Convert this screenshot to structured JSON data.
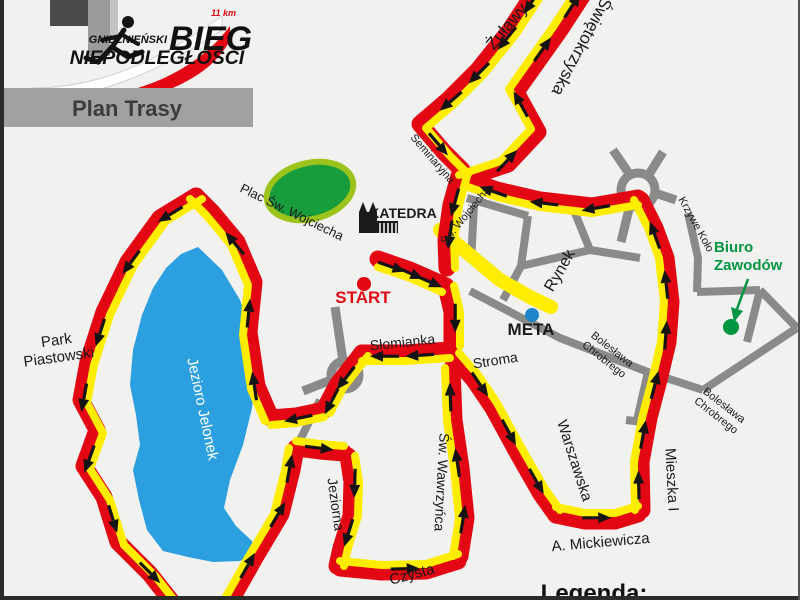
{
  "logo": {
    "distance": "11 km",
    "city": "GNIEŹNIEŃSKI",
    "bieg": "BIEG",
    "niepodleglosci": "NIEPODLEGŁOŚCI"
  },
  "banner": {
    "label": "Plan Trasy"
  },
  "legend": {
    "label": "Legenda:"
  },
  "colors": {
    "route_red": "#e30613",
    "route_yellow": "#ffed00",
    "road_gray": "#8a8a89",
    "lake_blue": "#2c9fe0",
    "park_fill": "#189d3c",
    "park_ring": "#9bc31c",
    "green": "#009540",
    "meta_blue": "#1e86c9",
    "arrow": "#141414",
    "label": "#1a1a1a"
  },
  "map": {
    "lake": [
      [
        198,
        247
      ],
      [
        222,
        270
      ],
      [
        240,
        300
      ],
      [
        252,
        335
      ],
      [
        256,
        372
      ],
      [
        252,
        408
      ],
      [
        243,
        445
      ],
      [
        230,
        480
      ],
      [
        224,
        508
      ],
      [
        236,
        526
      ],
      [
        252,
        541
      ],
      [
        256,
        553
      ],
      [
        240,
        561
      ],
      [
        213,
        562
      ],
      [
        188,
        557
      ],
      [
        163,
        551
      ],
      [
        147,
        530
      ],
      [
        139,
        500
      ],
      [
        133,
        470
      ],
      [
        140,
        445
      ],
      [
        136,
        415
      ],
      [
        130,
        385
      ],
      [
        133,
        350
      ],
      [
        142,
        315
      ],
      [
        153,
        288
      ],
      [
        166,
        268
      ],
      [
        181,
        254
      ]
    ],
    "park_ellipse": {
      "cx": 310,
      "cy": 191,
      "rx": 44,
      "ry": 28,
      "rot": -14
    },
    "roads": [
      [
        [
          467,
          198
        ],
        [
          528,
          216
        ]
      ],
      [
        [
          528,
          216
        ],
        [
          521,
          266
        ]
      ],
      [
        [
          575,
          213
        ],
        [
          590,
          250
        ]
      ],
      [
        [
          521,
          266
        ],
        [
          590,
          250
        ]
      ],
      [
        [
          590,
          250
        ],
        [
          640,
          258
        ]
      ],
      [
        [
          521,
          266
        ],
        [
          503,
          300
        ]
      ],
      [
        [
          470,
          291
        ],
        [
          560,
          338
        ],
        [
          648,
          372
        ],
        [
          703,
          390
        ]
      ],
      [
        [
          648,
          372
        ],
        [
          637,
          420
        ]
      ],
      [
        [
          626,
          420
        ],
        [
          650,
          423
        ]
      ],
      [
        [
          697,
          292
        ],
        [
          760,
          290
        ]
      ],
      [
        [
          760,
          290
        ],
        [
          797,
          328
        ]
      ],
      [
        [
          760,
          290
        ],
        [
          747,
          342
        ]
      ],
      [
        [
          703,
          390
        ],
        [
          797,
          328
        ]
      ],
      [
        [
          688,
          213
        ],
        [
          698,
          258
        ],
        [
          697,
          292
        ]
      ],
      [
        [
          474,
          205
        ],
        [
          471,
          262
        ]
      ],
      [
        [
          320,
          400
        ],
        [
          296,
          448
        ]
      ]
    ],
    "roundabouts": [
      {
        "cx": 638,
        "cy": 190,
        "r": 17,
        "arms": [
          [
            [
              630,
              175
            ],
            [
              613,
              150
            ]
          ],
          [
            [
              648,
              176
            ],
            [
              663,
              152
            ]
          ],
          [
            [
              630,
              205
            ],
            [
              621,
              242
            ]
          ],
          [
            [
              655,
              193
            ],
            [
              676,
              200
            ]
          ]
        ]
      },
      {
        "cx": 345,
        "cy": 375,
        "r": 14,
        "arms": [
          [
            [
              343,
              361
            ],
            [
              335,
              307
            ]
          ],
          [
            [
              331,
              380
            ],
            [
              303,
              391
            ]
          ]
        ]
      }
    ],
    "finish_chute": {
      "points": [
        [
          440,
          230
        ],
        [
          470,
          255
        ],
        [
          500,
          280
        ],
        [
          530,
          297
        ],
        [
          551,
          307
        ]
      ],
      "width": 14
    },
    "route": [
      {
        "id": "zulawy",
        "points": [
          [
            540,
            -16
          ],
          [
            510,
            30
          ],
          [
            478,
            70
          ],
          [
            448,
            100
          ],
          [
            420,
            124
          ],
          [
            444,
            152
          ],
          [
            462,
            170
          ]
        ],
        "off": [
          6,
          4
        ],
        "arrows": [
          0.08,
          0.26,
          0.44,
          0.6,
          0.85
        ]
      },
      {
        "id": "swietokrzyska",
        "points": [
          [
            466,
            178
          ],
          [
            508,
            164
          ],
          [
            538,
            132
          ],
          [
            516,
            92
          ],
          [
            560,
            30
          ],
          [
            590,
            -16
          ]
        ],
        "off": [
          -7,
          -3
        ],
        "arrows": [
          0.18,
          0.45,
          0.7,
          0.9
        ]
      },
      {
        "id": "sw-wojciecha",
        "points": [
          [
            459,
            176
          ],
          [
            451,
            205
          ],
          [
            446,
            240
          ],
          [
            447,
            268
          ]
        ],
        "off": [
          8,
          0
        ],
        "arrows": [
          0.3,
          0.65
        ]
      },
      {
        "id": "start-stretch",
        "points": [
          [
            378,
            259
          ],
          [
            410,
            270
          ],
          [
            442,
            284
          ]
        ],
        "off": [
          0,
          8
        ],
        "arrows": [
          0.22,
          0.5,
          0.8
        ]
      },
      {
        "id": "stroma-down",
        "points": [
          [
            446,
            286
          ],
          [
            452,
            312
          ],
          [
            452,
            346
          ]
        ],
        "off": [
          8,
          0
        ],
        "arrows": [
          0.55
        ]
      },
      {
        "id": "slomianka",
        "points": [
          [
            450,
            350
          ],
          [
            405,
            353
          ],
          [
            362,
            353
          ]
        ],
        "off": [
          0,
          8
        ],
        "arrows": [
          0.35,
          0.75
        ]
      },
      {
        "id": "to-lake",
        "points": [
          [
            362,
            353
          ],
          [
            337,
            385
          ],
          [
            324,
            410
          ]
        ],
        "off": [
          6,
          3
        ],
        "arrows": [
          0.45,
          0.85
        ]
      },
      {
        "id": "lake-out",
        "points": [
          [
            324,
            410
          ],
          [
            296,
            416
          ],
          [
            271,
            418
          ]
        ],
        "off": [
          0,
          7
        ],
        "arrows": [
          0.5
        ]
      },
      {
        "id": "lake-east-up",
        "points": [
          [
            271,
            418
          ],
          [
            257,
            386
          ],
          [
            249,
            332
          ],
          [
            254,
            282
          ],
          [
            237,
            242
          ],
          [
            212,
            212
          ],
          [
            196,
            196
          ]
        ],
        "off": [
          -6,
          3
        ],
        "arrows": [
          0.15,
          0.45,
          0.75
        ]
      },
      {
        "id": "lake-west-down",
        "points": [
          [
            196,
            196
          ],
          [
            160,
            218
          ],
          [
            128,
            262
          ],
          [
            104,
            312
          ],
          [
            88,
            362
          ],
          [
            81,
            400
          ],
          [
            97,
            430
          ],
          [
            84,
            466
          ],
          [
            104,
            497
          ],
          [
            118,
            542
          ],
          [
            150,
            574
          ],
          [
            172,
            602
          ]
        ],
        "off": [
          6,
          3
        ],
        "arrows": [
          0.07,
          0.2,
          0.36,
          0.5,
          0.64,
          0.78,
          0.92
        ]
      },
      {
        "id": "lake-return-up",
        "points": [
          [
            230,
            602
          ],
          [
            256,
            556
          ],
          [
            281,
            514
          ],
          [
            292,
            470
          ],
          [
            296,
            448
          ]
        ],
        "off": [
          -7,
          0
        ],
        "arrows": [
          0.25,
          0.6,
          0.88
        ]
      },
      {
        "id": "jeziorna-east",
        "points": [
          [
            296,
            448
          ],
          [
            320,
            451
          ],
          [
            344,
            453
          ]
        ],
        "off": [
          0,
          -7
        ],
        "arrows": [
          0.5
        ]
      },
      {
        "id": "jeziorna-down",
        "points": [
          [
            348,
            456
          ],
          [
            352,
            482
          ],
          [
            351,
            516
          ],
          [
            341,
            548
          ],
          [
            337,
            566
          ]
        ],
        "off": [
          7,
          0
        ],
        "arrows": [
          0.25,
          0.7
        ]
      },
      {
        "id": "czysta",
        "points": [
          [
            340,
            568
          ],
          [
            382,
            572
          ],
          [
            426,
            571
          ],
          [
            458,
            561
          ]
        ],
        "off": [
          0,
          -7
        ],
        "arrows": [
          0.55
        ]
      },
      {
        "id": "wawrzynca-up",
        "points": [
          [
            460,
            556
          ],
          [
            466,
            518
          ],
          [
            461,
            468
          ],
          [
            454,
            420
          ],
          [
            452,
            368
          ]
        ],
        "off": [
          -7,
          0
        ],
        "arrows": [
          0.2,
          0.5,
          0.85
        ]
      },
      {
        "id": "stroma-warszawska",
        "points": [
          [
            455,
            358
          ],
          [
            474,
            380
          ],
          [
            493,
            408
          ],
          [
            517,
            452
          ],
          [
            541,
            494
          ],
          [
            556,
            515
          ]
        ],
        "off": [
          4,
          -5
        ],
        "arrows": [
          0.2,
          0.5,
          0.8
        ]
      },
      {
        "id": "mickiewicza",
        "points": [
          [
            556,
            515
          ],
          [
            585,
            521
          ],
          [
            615,
            521
          ],
          [
            638,
            514
          ]
        ],
        "off": [
          0,
          -8
        ],
        "arrows": [
          0.5
        ]
      },
      {
        "id": "mieszka-boleslawa-up",
        "points": [
          [
            642,
            510
          ],
          [
            641,
            462
          ],
          [
            649,
            418
          ],
          [
            659,
            380
          ],
          [
            668,
            342
          ],
          [
            671,
            302
          ],
          [
            666,
            258
          ],
          [
            655,
            228
          ],
          [
            641,
            200
          ]
        ],
        "off": [
          -7,
          0
        ],
        "arrows": [
          0.08,
          0.24,
          0.4,
          0.56,
          0.72,
          0.88
        ]
      },
      {
        "id": "band-west",
        "points": [
          [
            638,
            198
          ],
          [
            592,
            206
          ],
          [
            540,
            200
          ],
          [
            497,
            190
          ],
          [
            468,
            180
          ]
        ],
        "off": [
          0,
          7
        ],
        "arrows": [
          0.25,
          0.55,
          0.85
        ]
      }
    ],
    "markers": {
      "start": {
        "x": 364,
        "y": 284,
        "r": 7
      },
      "meta": {
        "x": 532,
        "y": 315,
        "r": 7
      },
      "biuro": {
        "x": 731,
        "y": 327,
        "r": 8,
        "arrow_from": [
          748,
          279
        ],
        "arrow_to": [
          737,
          309
        ]
      }
    },
    "labels": [
      {
        "id": "zulawy",
        "text": "Żuławy",
        "x": 511,
        "y": 30,
        "rot": -50,
        "size": 17
      },
      {
        "id": "swietokrzyska",
        "text": "Świętokrzyska",
        "x": 577,
        "y": 44,
        "rot": 118,
        "size": 17
      },
      {
        "id": "seminaryjna",
        "text": "Seminaryjna",
        "x": 430,
        "y": 161,
        "rot": 49,
        "size": 11
      },
      {
        "id": "sw-wojciecha",
        "text": "Św. Wojciecha",
        "x": 468,
        "y": 218,
        "rot": -51,
        "size": 11
      },
      {
        "id": "rynek",
        "text": "Rynek",
        "x": 564,
        "y": 273,
        "rot": -60,
        "size": 16
      },
      {
        "id": "krzywe-kolo",
        "text": "Krzywe Koło",
        "x": 693,
        "y": 226,
        "rot": 61,
        "size": 11
      },
      {
        "id": "slomianka",
        "text": "Słomianka",
        "x": 403,
        "y": 347,
        "rot": -6,
        "size": 14
      },
      {
        "id": "stroma",
        "text": "Stroma",
        "x": 496,
        "y": 365,
        "rot": -9,
        "size": 14
      },
      {
        "id": "boleslawa-1",
        "lines": [
          "Bolesława",
          "Chrobrego"
        ],
        "x": 610,
        "y": 352,
        "rot": 38,
        "size": 11,
        "lh": 13
      },
      {
        "id": "boleslawa-2",
        "lines": [
          "Bolesława",
          "Chrobrego"
        ],
        "x": 722,
        "y": 408,
        "rot": 38,
        "size": 11,
        "lh": 13
      },
      {
        "id": "warszawska",
        "text": "Warszawska",
        "x": 570,
        "y": 462,
        "rot": 72,
        "size": 15
      },
      {
        "id": "mieszka",
        "text": "Mieszka I",
        "x": 667,
        "y": 480,
        "rot": 87,
        "size": 15
      },
      {
        "id": "mickiewicza",
        "text": "A. Mickiewicza",
        "x": 601,
        "y": 547,
        "rot": -5,
        "size": 15
      },
      {
        "id": "czysta",
        "text": "Czysta",
        "x": 413,
        "y": 579,
        "rot": -15,
        "size": 15
      },
      {
        "id": "wawrzynca",
        "text": "Św. Wawrzyńca",
        "x": 437,
        "y": 482,
        "rot": 93,
        "size": 14
      },
      {
        "id": "jeziorna",
        "text": "Jeziorna",
        "x": 331,
        "y": 505,
        "rot": 82,
        "size": 14
      },
      {
        "id": "jezioro-jelonek",
        "text": "Jezioro Jelonek",
        "x": 198,
        "y": 410,
        "rot": 78,
        "size": 15,
        "color": "#ffffff"
      },
      {
        "id": "park-piastowski",
        "lines": [
          "Park",
          "Piastowski"
        ],
        "x": 57,
        "y": 345,
        "rot": -8,
        "size": 15,
        "lh": 17
      },
      {
        "id": "plac-wojciecha",
        "text": "Plac Św. Wojciecha",
        "x": 290,
        "y": 216,
        "rot": 26,
        "size": 13
      },
      {
        "id": "katedra",
        "text": "KATEDRA",
        "x": 403,
        "y": 218,
        "rot": 0,
        "size": 14,
        "weight": "bold"
      },
      {
        "id": "start",
        "text": "START",
        "x": 363,
        "y": 303,
        "rot": 0,
        "size": 17,
        "weight": "bold",
        "color": "#e30613"
      },
      {
        "id": "meta",
        "text": "META",
        "x": 531,
        "y": 335,
        "rot": 0,
        "size": 17,
        "weight": "bold"
      },
      {
        "id": "biuro-zawodow",
        "lines": [
          "Biuro",
          "Zawodów"
        ],
        "x": 714,
        "y": 252,
        "rot": 0,
        "size": 15,
        "lh": 18,
        "weight": "bold",
        "color": "#009540",
        "anchor": "start"
      }
    ]
  }
}
